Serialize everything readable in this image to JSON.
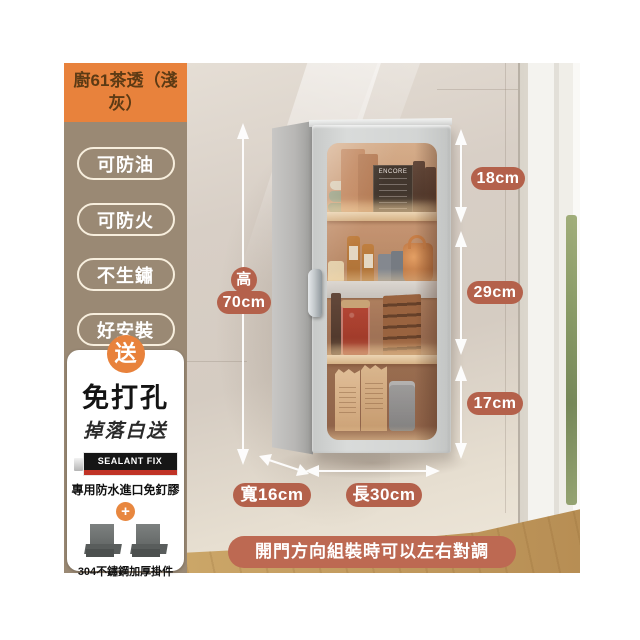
{
  "product_card": {
    "title": "廚61茶透（淺灰）",
    "features": [
      "可防油",
      "可防火",
      "不生鏽",
      "好安裝"
    ],
    "gift": {
      "badge": "送",
      "headline": "免打孔",
      "subline": "掉落白送",
      "glue_brand": "SEALANT FIX",
      "glue_name": "專用防水進口免釘膠",
      "plus": "+",
      "hardware_name": "304不鏽鋼加厚掛件"
    }
  },
  "dimensions": {
    "height_char": "高",
    "height_value": "70cm",
    "top_section": "18cm",
    "middle_section": "29cm",
    "bottom_section": "17cm",
    "depth_label": "寬16cm",
    "width_label": "長30cm"
  },
  "banner": {
    "text": "開門方向組裝時可以左右對調"
  },
  "scene": {
    "chalkboard_text": "ENCORE"
  },
  "colors": {
    "accent_orange": "#e8823c",
    "sidebar_brown": "#9a8974",
    "badge_terracotta": "#b4614b",
    "banner_terracotta": "#bd6952"
  }
}
